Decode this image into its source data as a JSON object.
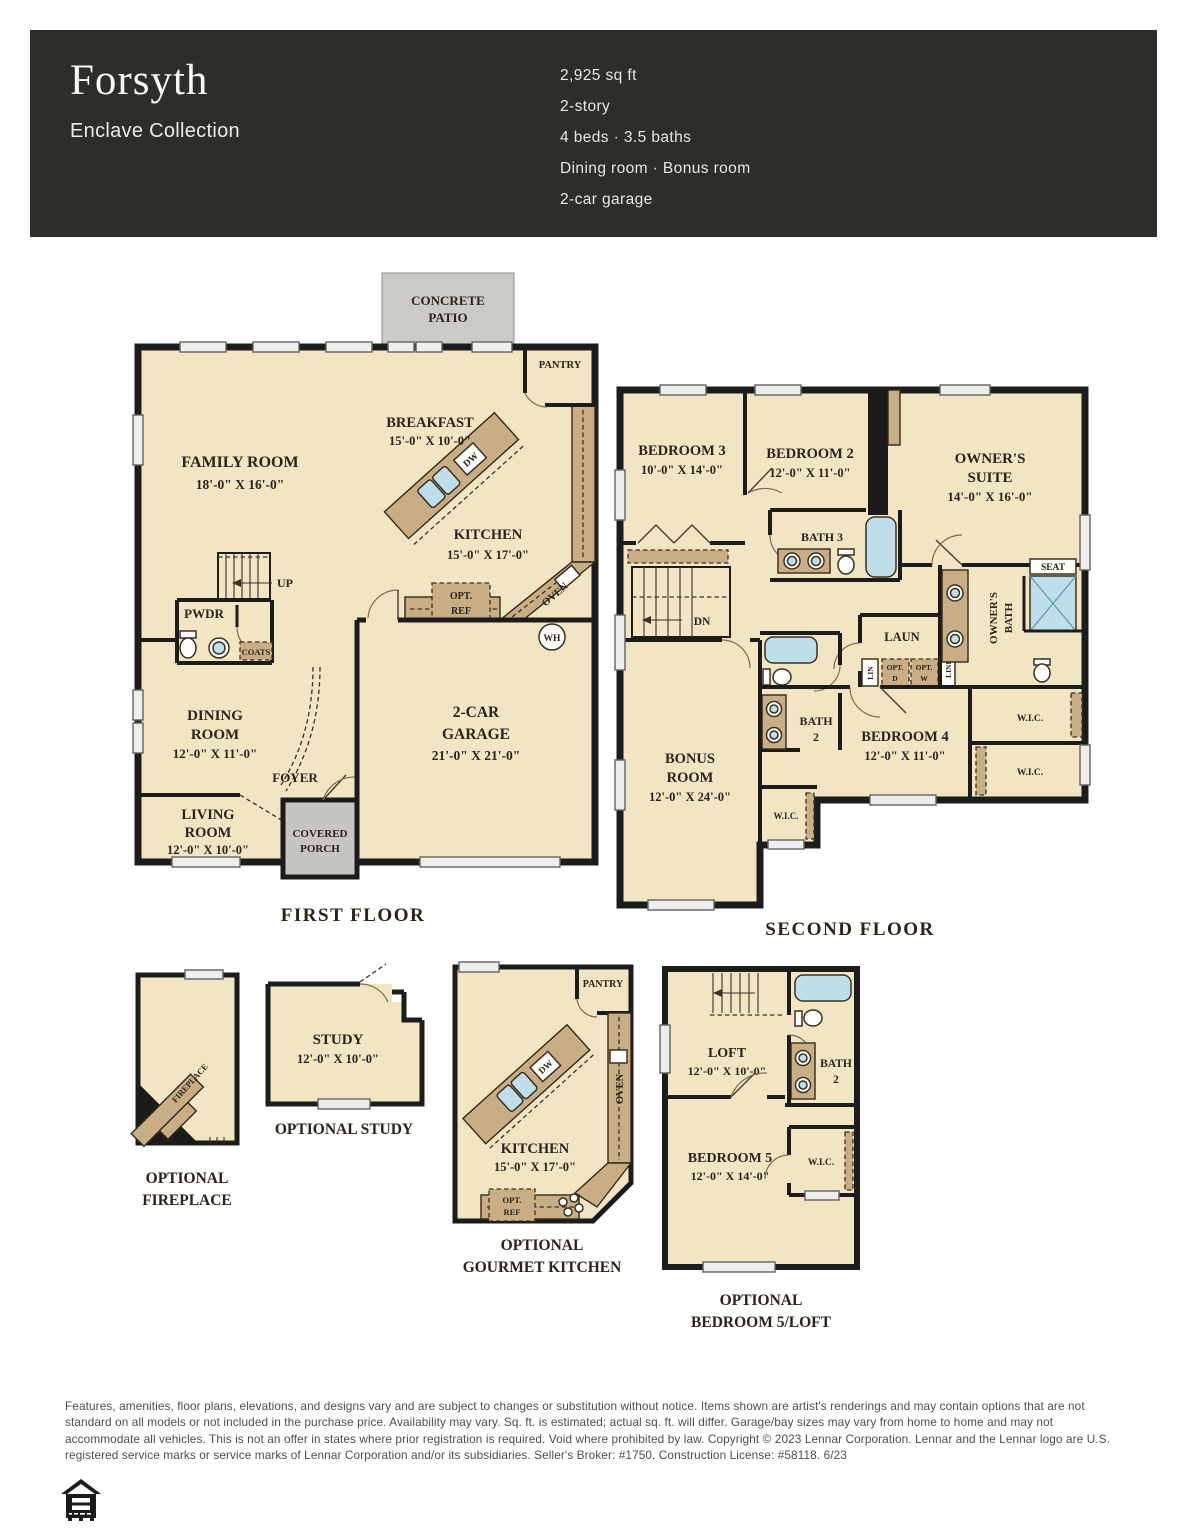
{
  "header": {
    "title": "Forsyth",
    "collection": "Enclave Collection",
    "specs": [
      "2,925 sq ft",
      "2-story",
      "4 beds · 3.5 baths",
      "Dining room · Bonus room",
      "2-car garage"
    ],
    "bg_color": "#2e2d2a",
    "text_color": "#f6f4ef"
  },
  "colors": {
    "room_fill": "#f1e5c4",
    "counter": "#c9ae85",
    "wall": "#1c1c1c",
    "patio_gray": "#cbcac6",
    "fixture_blue": "#bedfe9"
  },
  "first_floor": {
    "caption": "FIRST FLOOR",
    "patio1": "CONCRETE",
    "patio2": "PATIO",
    "family": "FAMILY ROOM",
    "family_dims": "18'-0\" X 16'-0\"",
    "breakfast": "BREAKFAST",
    "breakfast_dims": "15'-0\" X 10'-0\"",
    "kitchen": "KITCHEN",
    "kitchen_dims": "15'-0\" X 17'-0\"",
    "pantry": "PANTRY",
    "dw": "DW",
    "oven": "OVEN",
    "opt1": "OPT.",
    "opt2": "REF",
    "wh": "WH",
    "up": "UP",
    "pwdr": "PWDR",
    "coats": "COATS",
    "dining1": "DINING",
    "dining2": "ROOM",
    "dining_dims": "12'-0\" X 11'-0\"",
    "foyer": "FOYER",
    "living1": "LIVING",
    "living2": "ROOM",
    "living_dims": "12'-0\" X 10'-0\"",
    "porch1": "COVERED",
    "porch2": "PORCH",
    "garage1": "2-CAR",
    "garage2": "GARAGE",
    "garage_dims": "21'-0\" X 21'-0\""
  },
  "second_floor": {
    "caption": "SECOND FLOOR",
    "bedroom3": "BEDROOM 3",
    "bedroom3_dims": "10'-0\" X 14'-0\"",
    "bedroom2": "BEDROOM 2",
    "bedroom2_dims": "12'-0\" X 11'-0\"",
    "owners1": "OWNER'S",
    "owners2": "SUITE",
    "owners_dims": "14'-0\" X 16'-0\"",
    "bath3": "BATH 3",
    "dn": "DN",
    "laun": "LAUN",
    "lin": "LIN",
    "optd1": "OPT.",
    "optd2": "D",
    "optw1": "OPT.",
    "optw2": "W",
    "linen": "LINEN",
    "owners_bath1": "OWNER'S",
    "owners_bath2": "BATH",
    "seat": "SEAT",
    "bath2a": "BATH",
    "bath2b": "2",
    "bedroom4": "BEDROOM 4",
    "bedroom4_dims": "12'-0\" X 11'-0\"",
    "bonus1": "BONUS",
    "bonus2": "ROOM",
    "bonus_dims": "12'-0\" X 24'-0\"",
    "wic1": "W.I.C.",
    "wic2": "W.I.C.",
    "wic3": "W.I.C."
  },
  "opt_fireplace": {
    "caption1": "OPTIONAL",
    "caption2": "FIREPLACE",
    "fireplace": "FIREPLACE"
  },
  "opt_study": {
    "caption": "OPTIONAL STUDY",
    "study": "STUDY",
    "study_dims": "12'-0\" X 10'-0\""
  },
  "opt_kitchen": {
    "caption1": "OPTIONAL",
    "caption2": "GOURMET KITCHEN",
    "kitchen": "KITCHEN",
    "kitchen_dims": "15'-0\" X 17'-0\"",
    "pantry": "PANTRY",
    "dw": "DW",
    "oven": "OVEN",
    "opt1": "OPT.",
    "opt2": "REF"
  },
  "opt_bed5": {
    "caption1": "OPTIONAL",
    "caption2": "BEDROOM 5/LOFT",
    "loft": "LOFT",
    "loft_dims": "12'-0\" X 10'-0\"",
    "dn": "DN",
    "bath2a": "BATH",
    "bath2b": "2",
    "bedroom5": "BEDROOM 5",
    "bedroom5_dims": "12'-0\" X 14'-0\"",
    "wic": "W.I.C."
  },
  "legal": {
    "disclaimer": "Features, amenities, floor plans, elevations, and designs vary and are subject to changes or substitution without notice. Items shown are artist's renderings and may contain options that are not standard on all models or not included in the purchase price. Availability may vary. Sq. ft. is estimated; actual sq. ft. will differ. Garage/bay sizes may vary from home to home and may not accommodate all vehicles. This is not an offer in states where prior registration is required. Void where prohibited by law. Copyright © 2023 Lennar Corporation. Lennar and the Lennar logo are U.S. registered service marks or service marks of Lennar Corporation and/or its subsidiaries. Seller's Broker: #1750. Construction License: #58118. 6/23",
    "logo": "equal-housing-opportunity"
  }
}
